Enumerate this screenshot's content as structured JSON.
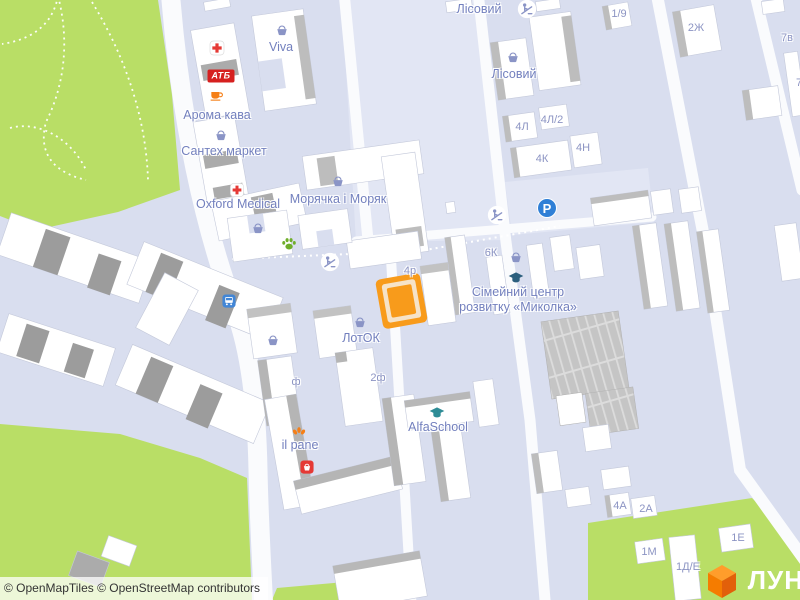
{
  "map_labels": {
    "lisovyi_top": "Лісовий",
    "viva": "Viva",
    "atb": "АТБ",
    "aroma_kava": "Арома кава",
    "santekh_market": "Сантех маркет",
    "oxford_medical": "Oxford Medical",
    "moryachka": "Морячка і Моряк",
    "lisovyi_2": "Лісовий",
    "simeinyi_line1": "Сімейний центр",
    "simeinyi_line2": "розвитку «Миколка»",
    "lotok": "ЛотОК",
    "il_pane": "il pane",
    "alfaschool": "AlfaSchool",
    "parking": "P"
  },
  "house_numbers": {
    "n1_9": "1/9",
    "n2zh": "2Ж",
    "n7v": "7в",
    "n7": "7",
    "n4l": "4Л",
    "n4l2": "4Л/2",
    "n4k": "4К",
    "n4n": "4Н",
    "n6k": "6К",
    "n4r": "4р",
    "nf": "ф",
    "n2f": "2ф",
    "n4a": "4А",
    "n2a": "2А",
    "n1m": "1М",
    "n1e": "1Е",
    "n1de": "1Д/Е"
  },
  "attribution": "© OpenMapTiles © OpenStreetMap contributors",
  "logo": {
    "text": "ЛУН"
  },
  "icon_names": [
    "shopping-basket-icon",
    "pharmacy-cross-icon",
    "coffee-cup-icon",
    "paw-icon",
    "playground-icon",
    "bus-stop-icon",
    "parking-icon",
    "graduation-cap-icon",
    "bakery-icon",
    "grocery-store-icon",
    "lun-cube-logo"
  ],
  "colors": {
    "park_green": "#B9DE66",
    "map_background": "#D9DEEF",
    "road_white": "#FAFBFD",
    "building_white": "#FFFFFF",
    "building_shadow": "#9C9C9C",
    "highlight_orange": "#F89B1B",
    "poi_label": "#7380BE",
    "house_number": "#8C94C3",
    "brand_orange": "#F57C00"
  }
}
